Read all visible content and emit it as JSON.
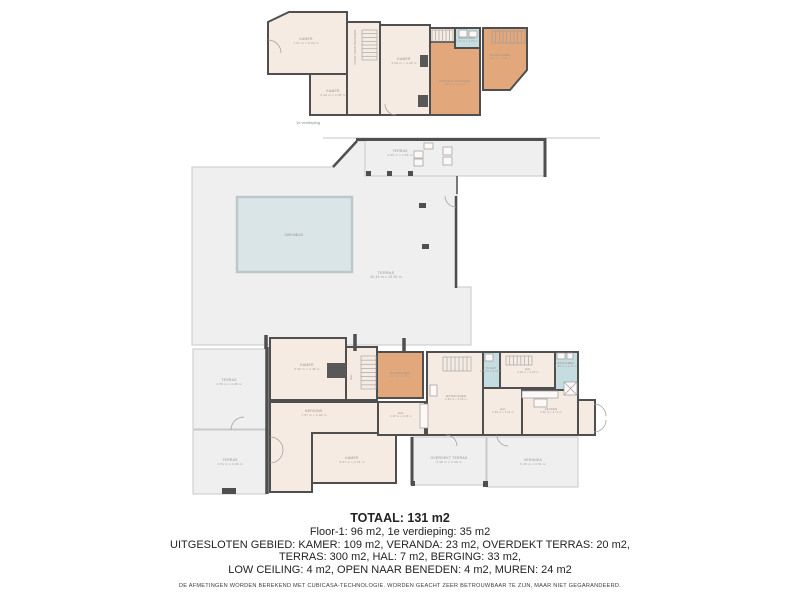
{
  "colors": {
    "wall": "#4f4f4f",
    "room": "#f5ebe3",
    "bedroom": "#e2a87c",
    "bath": "#c5dde0",
    "terrace": "#efefef",
    "terraceStroke": "#c9c9c9",
    "pool": "#d9e5e7",
    "poolStroke": "#bdc7c9",
    "label": "#9a8f88",
    "dims": "#a59b94",
    "stair": "#9b9b9b",
    "block": "#585858",
    "roofline": "#b4b4b4"
  },
  "floorplan": {
    "rooms": [
      {
        "id": "kamer-1e-groot",
        "type": "room",
        "points": [
          [
            268,
            22
          ],
          [
            289,
            12
          ],
          [
            347,
            12
          ],
          [
            347,
            74
          ],
          [
            268,
            74
          ]
        ],
        "label": "KAMER",
        "dims": "7.97 m x 6.00 m",
        "lx": 306,
        "ly": 40
      },
      {
        "id": "kamer-1e-klein",
        "type": "room",
        "rect": [
          310,
          74,
          48,
          41
        ],
        "label": "KAMER",
        "dims": "3.49 m x 3.05 m",
        "lx": 333,
        "ly": 92
      },
      {
        "id": "trapgat-1e",
        "type": "room",
        "rect": [
          347,
          22,
          33,
          93
        ],
        "vlabel": "OPEN NAAR BENEDEN",
        "lx": 356,
        "ly": 47
      },
      {
        "id": "kamer-1e-midden",
        "type": "room",
        "rect": [
          380,
          25,
          50,
          90
        ],
        "label": "KAMER",
        "dims": "3.65 m x 4.28 m",
        "lx": 404,
        "ly": 60
      },
      {
        "id": "overloop-1e",
        "type": "room",
        "rect": [
          430,
          28,
          25,
          14
        ]
      },
      {
        "id": "hoofdslaapkamer",
        "type": "bedroom",
        "points": [
          [
            430,
            42
          ],
          [
            455,
            42
          ],
          [
            455,
            48
          ],
          [
            480,
            48
          ],
          [
            480,
            115
          ],
          [
            430,
            115
          ]
        ],
        "label": "HOOFDSLAAPKAMER",
        "dims": "3.69 m x 3.36 m",
        "lx": 455,
        "ly": 82,
        "small": true
      },
      {
        "id": "badkamer-1e",
        "type": "bath",
        "rect": [
          455,
          28,
          25,
          20
        ],
        "label": "BADKAMER",
        "dims": "1.87 m x 1.86 m",
        "lx": 467,
        "ly": 39,
        "small": true
      },
      {
        "id": "slaapkamer-1e",
        "type": "bedroom",
        "points": [
          [
            483,
            28
          ],
          [
            527,
            28
          ],
          [
            527,
            70
          ],
          [
            510,
            90
          ],
          [
            483,
            90
          ]
        ],
        "label": "SLAAPKAMER",
        "dims": "3.60 m x 3.35 m",
        "lx": 500,
        "ly": 56,
        "small": true
      },
      {
        "id": "terras-boven",
        "type": "terrace",
        "rect": [
          365,
          140,
          180,
          36
        ],
        "label": "TERRAS",
        "dims": "4.55 m x 3.56 m",
        "lx": 400,
        "ly": 152
      },
      {
        "id": "terras-hoofd",
        "type": "terrace",
        "points": [
          [
            192,
            167
          ],
          [
            333,
            167
          ],
          [
            357,
            141
          ],
          [
            365,
            141
          ],
          [
            365,
            176
          ],
          [
            457,
            176
          ],
          [
            457,
            287
          ],
          [
            471,
            287
          ],
          [
            471,
            345
          ],
          [
            192,
            345
          ]
        ],
        "label": "TERRAS",
        "dims": "30.45 m x 15.55 m",
        "lx": 386,
        "ly": 274,
        "big": true
      },
      {
        "id": "zwembad",
        "type": "pool",
        "rect": [
          237,
          197,
          115,
          75
        ],
        "label": "ZWEMBAD",
        "lx": 294,
        "ly": 236
      },
      {
        "id": "terras-links-boven",
        "type": "terrace",
        "rect": [
          193,
          349,
          73,
          80
        ],
        "label": "TERRAS",
        "dims": "3.56 m x 4.28 m",
        "lx": 229,
        "ly": 381
      },
      {
        "id": "terras-links-onder",
        "type": "terrace",
        "rect": [
          193,
          430,
          73,
          64
        ],
        "label": "TERRAS",
        "dims": "3.51 m x 3.06 m",
        "lx": 230,
        "ly": 461
      },
      {
        "id": "kamer-boven",
        "type": "room",
        "rect": [
          270,
          338,
          76,
          62
        ],
        "label": "KAMER",
        "dims": "5.50 m x 4.45 m",
        "lx": 307,
        "ly": 366
      },
      {
        "id": "berging",
        "type": "room",
        "points": [
          [
            270,
            402
          ],
          [
            378,
            402
          ],
          [
            378,
            433
          ],
          [
            312,
            433
          ],
          [
            312,
            492
          ],
          [
            270,
            492
          ]
        ],
        "label": "BERGING",
        "dims": "7.97 m x 6.99 m",
        "lx": 314,
        "ly": 412
      },
      {
        "id": "kamer-onder",
        "type": "room",
        "rect": [
          312,
          433,
          84,
          50
        ],
        "label": "KAMER",
        "dims": "5.67 m x 3.51 m",
        "lx": 352,
        "ly": 459
      },
      {
        "id": "hal-trap",
        "type": "room",
        "rect": [
          346,
          347,
          31,
          53
        ],
        "vlabel": "HAL",
        "lx": 352,
        "ly": 377
      },
      {
        "id": "slaapkamer-begane",
        "type": "bedroom",
        "rect": [
          377,
          352,
          46,
          46
        ],
        "label": "SLAAPKAMER",
        "dims": "3.37 m x 3.35 m",
        "lx": 400,
        "ly": 374,
        "small": true
      },
      {
        "id": "hal-2",
        "type": "room",
        "rect": [
          378,
          402,
          47,
          33
        ],
        "label": "HAL",
        "dims": "3.26 m x 2.39 m",
        "lx": 401,
        "ly": 414,
        "small": true
      },
      {
        "id": "woonkamer",
        "type": "room",
        "rect": [
          427,
          352,
          56,
          83
        ],
        "label": "WOONKAMER",
        "dims": "3.69 m x 5.05 m",
        "lx": 456,
        "ly": 397,
        "small": true
      },
      {
        "id": "toilet",
        "type": "bath",
        "rect": [
          483,
          352,
          17,
          36
        ],
        "label": "TOILET",
        "dims": "1.06 m x 2.62 m",
        "lx": 491,
        "ly": 369,
        "small": true
      },
      {
        "id": "hal-boven",
        "type": "room",
        "rect": [
          500,
          352,
          55,
          36
        ],
        "label": "HAL",
        "dims": "4.49 m x 2.00 m",
        "lx": 528,
        "ly": 370,
        "small": true
      },
      {
        "id": "badkamer-begane",
        "type": "bath",
        "rect": [
          555,
          352,
          23,
          43
        ],
        "label": "BADKAMER",
        "dims": "1.66 m x 2.65 m",
        "lx": 566,
        "ly": 364,
        "small": true
      },
      {
        "id": "hal-midden",
        "type": "room",
        "rect": [
          483,
          388,
          39,
          47
        ],
        "label": "HAL",
        "dims": "2.96 m x 3.04 m",
        "lx": 503,
        "ly": 410,
        "small": true
      },
      {
        "id": "keuken",
        "type": "room",
        "rect": [
          522,
          390,
          56,
          45
        ],
        "label": "KEUKEN",
        "dims": "4.56 m x 3.71 m",
        "lx": 551,
        "ly": 410,
        "small": true
      },
      {
        "id": "entree",
        "type": "room",
        "rect": [
          578,
          400,
          17,
          35
        ]
      },
      {
        "id": "overdekt-terras",
        "type": "terrace",
        "rect": [
          411,
          437,
          75,
          48
        ],
        "label": "OVERDEKT TERRAS",
        "dims": "5.58 m x 3.49 m",
        "lx": 449,
        "ly": 459
      },
      {
        "id": "veranda",
        "type": "terrace",
        "rect": [
          487,
          437,
          91,
          50
        ],
        "label": "VERANDA",
        "dims": "6.45 m x 3.51 m",
        "lx": 533,
        "ly": 461
      }
    ],
    "walls": [
      {
        "x1": 323,
        "y1": 138,
        "x2": 600,
        "y2": 138,
        "w": 0.8,
        "c": "roofline"
      },
      {
        "x1": 356,
        "y1": 139.5,
        "x2": 546.5,
        "y2": 139.5,
        "w": 3
      },
      {
        "x1": 545,
        "y1": 138,
        "x2": 545,
        "y2": 177,
        "w": 3
      },
      {
        "x1": 333,
        "y1": 167,
        "x2": 357,
        "y2": 141,
        "w": 2.5
      },
      {
        "x1": 456,
        "y1": 196,
        "x2": 456,
        "y2": 288,
        "w": 2.5
      },
      {
        "x1": 457,
        "y1": 176,
        "x2": 457,
        "y2": 194,
        "w": 1.5
      },
      {
        "x1": 267,
        "y1": 347,
        "x2": 267,
        "y2": 494,
        "w": 3.5
      },
      {
        "x1": 266,
        "y1": 335,
        "x2": 266,
        "y2": 349,
        "w": 3.5
      },
      {
        "x1": 355,
        "y1": 334,
        "x2": 355,
        "y2": 351,
        "w": 3.5
      },
      {
        "x1": 404,
        "y1": 338,
        "x2": 404,
        "y2": 351,
        "w": 3.5
      },
      {
        "x1": 412,
        "y1": 437,
        "x2": 412,
        "y2": 485,
        "w": 3
      }
    ],
    "stairs": [
      {
        "x": 362,
        "y": 30,
        "w": 15,
        "h": 30,
        "dir": "v",
        "n": 8
      },
      {
        "x": 432,
        "y": 30,
        "w": 21,
        "h": 12,
        "dir": "h",
        "n": 6
      },
      {
        "x": 492,
        "y": 31,
        "w": 33,
        "h": 12,
        "dir": "h",
        "n": 9
      },
      {
        "x": 361,
        "y": 356,
        "w": 15,
        "h": 33,
        "dir": "v",
        "n": 8
      },
      {
        "x": 443,
        "y": 357,
        "w": 28,
        "h": 14,
        "dir": "h",
        "n": 7
      },
      {
        "x": 506,
        "y": 356,
        "w": 26,
        "h": 9,
        "dir": "h",
        "n": 7
      }
    ],
    "blocks": [
      {
        "x": 327,
        "y": 363,
        "w": 19,
        "h": 15
      },
      {
        "x": 420,
        "y": 55,
        "w": 8,
        "h": 12
      },
      {
        "x": 418,
        "y": 95,
        "w": 10,
        "h": 12
      }
    ],
    "pillars": [
      {
        "x": 366,
        "y": 171,
        "w": 5,
        "h": 5
      },
      {
        "x": 387,
        "y": 171,
        "w": 5,
        "h": 5
      },
      {
        "x": 408,
        "y": 171,
        "w": 5,
        "h": 5
      },
      {
        "x": 419,
        "y": 203,
        "w": 7,
        "h": 5
      },
      {
        "x": 422,
        "y": 244,
        "w": 7,
        "h": 5
      },
      {
        "x": 222,
        "y": 488,
        "w": 14,
        "h": 6
      },
      {
        "x": 483,
        "y": 481,
        "w": 5,
        "h": 6
      },
      {
        "x": 411,
        "y": 481,
        "w": 4,
        "h": 5
      }
    ],
    "fixtures": [
      {
        "x": 414,
        "y": 151,
        "w": 9,
        "h": 7
      },
      {
        "x": 414,
        "y": 159,
        "w": 9,
        "h": 7
      },
      {
        "x": 424,
        "y": 143,
        "w": 9,
        "h": 6
      },
      {
        "x": 443,
        "y": 147,
        "w": 9,
        "h": 8
      },
      {
        "x": 443,
        "y": 157,
        "w": 9,
        "h": 8
      },
      {
        "x": 459,
        "y": 30,
        "w": 8,
        "h": 7
      },
      {
        "x": 469,
        "y": 31,
        "w": 8,
        "h": 6
      },
      {
        "x": 557,
        "y": 353,
        "w": 8,
        "h": 6
      },
      {
        "x": 567,
        "y": 353,
        "w": 6,
        "h": 6
      },
      {
        "x": 564,
        "y": 382,
        "w": 13,
        "h": 13,
        "cross": true
      },
      {
        "x": 522,
        "y": 391,
        "w": 36,
        "h": 7
      },
      {
        "x": 534,
        "y": 399,
        "w": 13,
        "h": 8
      },
      {
        "x": 485,
        "y": 354,
        "w": 8,
        "h": 7
      },
      {
        "x": 430,
        "y": 385,
        "w": 7,
        "h": 11
      },
      {
        "x": 420,
        "y": 404,
        "w": 8,
        "h": 24
      }
    ],
    "arcs": [
      "M268,40 A13,13 0 0 1 281,53",
      "M456,207 A11,11 0 0 1 445,196",
      "M270,437 A13,13 0 0 1 283,450",
      "M270,463 A13,13 0 0 0 283,450",
      "M231,430 A13,13 0 0 1 244,417",
      "M594,404 A12,12 0 0 1 606,416",
      "M594,432 A12,12 0 0 0 606,420",
      "M497,435 A11,11 0 0 0 508,446",
      "M446,435 A11,11 0 0 1 457,446",
      "M396,115 A11,11 0 0 1 385,104"
    ],
    "captions": [
      {
        "text": "1e verdieping",
        "x": 308,
        "y": 124,
        "fs": 4,
        "color": "#8a8a8a"
      }
    ]
  },
  "summary": {
    "total": "TOTAAL: 131 m2",
    "line1": "Floor-1: 96 m2, 1e verdieping: 35 m2",
    "line2": "UITGESLOTEN GEBIED: KAMER: 109 m2, VERANDA: 23 m2, OVERDEKT TERRAS: 20 m2,",
    "line3": "TERRAS: 300 m2, HAL: 7 m2, BERGING: 33 m2,",
    "line4": "LOW CEILING: 4 m2, OPEN NAAR BENEDEN: 4 m2, MUREN: 24 m2",
    "disclaimer": "DE AFMETINGEN WORDEN BEREKEND MET CUBICASA-TECHNOLOGIE. WORDEN GEACHT ZEER BETROUWBAAR TE ZIJN, MAAR NIET GEGARANDEERD."
  }
}
